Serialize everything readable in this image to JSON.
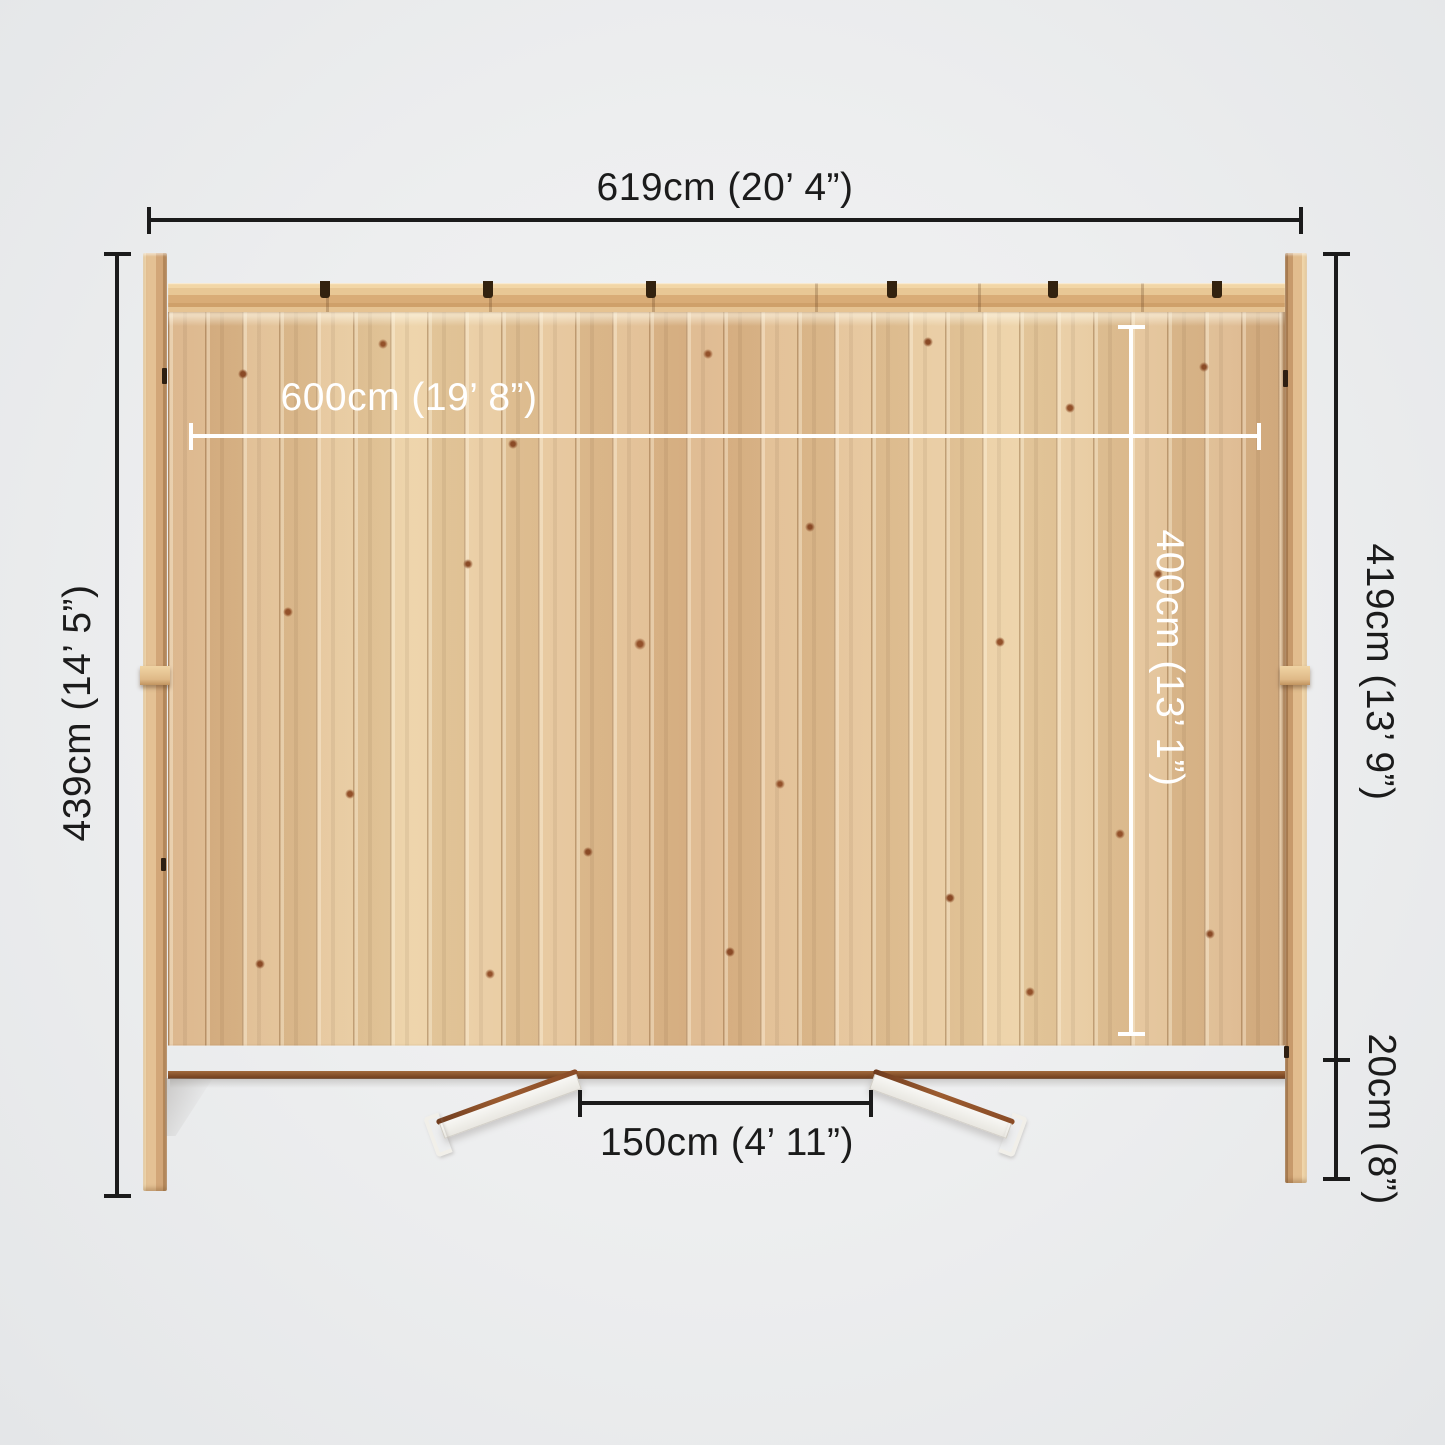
{
  "diagram": {
    "subject": "Log cabin top-down dimension view",
    "labels": {
      "overall_width": "619cm (20’ 4”)",
      "internal_width": "600cm (19’ 8”)",
      "overall_depth": "439cm (14’ 5”)",
      "internal_depth": "400cm (13’ 1”)",
      "side_depth": "419cm (13’ 9”)",
      "roof_overhang": "20cm (8”)",
      "door_opening": "150cm (4’ 11”)"
    },
    "colors": {
      "dimension_line": "#1b1b1b",
      "internal_dimension_line": "#ffffff",
      "wood_light": "#ecd0a3",
      "wood_dark": "#c79a6b",
      "wall_edge_strip": "#7c4824",
      "background": "#edeeef"
    }
  }
}
